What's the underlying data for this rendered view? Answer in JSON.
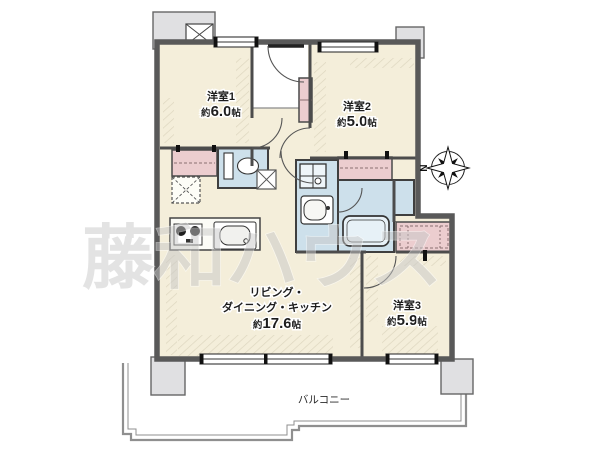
{
  "rooms": [
    {
      "id": "yoshitsu1",
      "name": "洋室1",
      "area_prefix": "約",
      "area_value": "6.0",
      "area_unit": "帖"
    },
    {
      "id": "yoshitsu2",
      "name": "洋室2",
      "area_prefix": "約",
      "area_value": "5.0",
      "area_unit": "帖"
    },
    {
      "id": "yoshitsu3",
      "name": "洋室3",
      "area_prefix": "約",
      "area_value": "5.9",
      "area_unit": "帖"
    }
  ],
  "ldk": {
    "line1": "リビング・",
    "line2": "ダイニング・キッチン",
    "area_prefix": "約",
    "area_value": "17.6",
    "area_unit": "帖"
  },
  "balcony": {
    "label": "バルコニー"
  },
  "compass": {
    "label": "N"
  },
  "watermark": {
    "text": "藤和ハウス"
  },
  "colors": {
    "floor": "#f4eeda",
    "wet_area": "#cde0eb",
    "closet": "#eccdcf",
    "wall": "#595959",
    "pillar": "#e0e0e2",
    "balcony_line": "#8f8f8f",
    "watermark": "#c8c8c8"
  }
}
